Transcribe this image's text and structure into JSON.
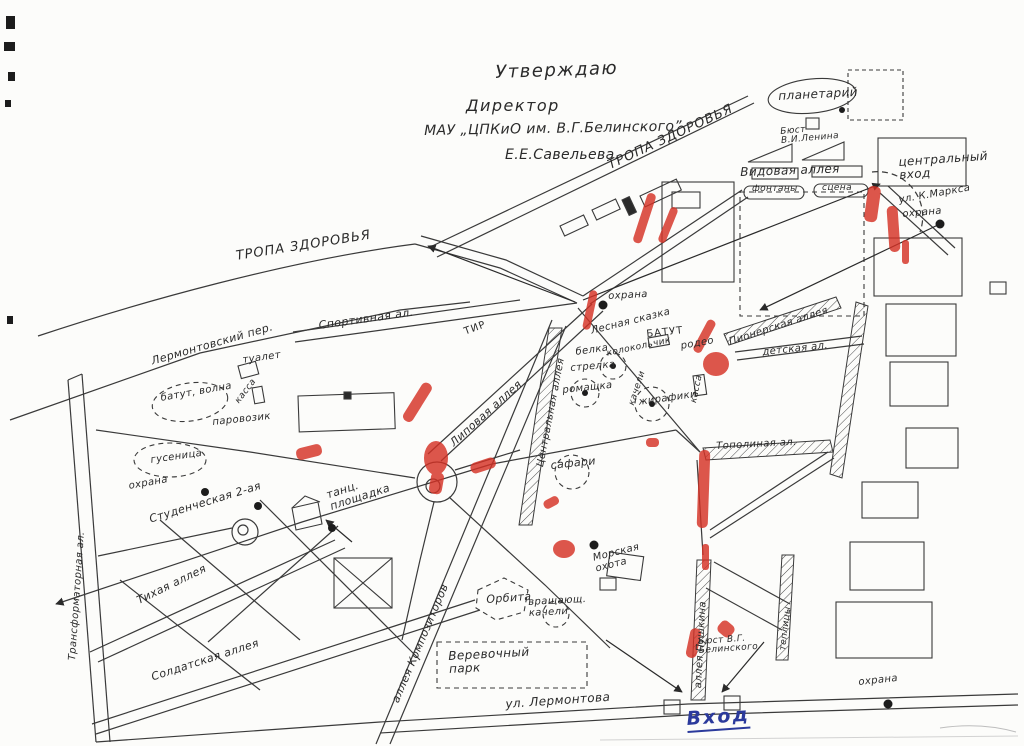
{
  "document": {
    "approval": {
      "line1": "Утверждаю",
      "line2": "Директор",
      "line3": "МАУ „ЦПКиО им. В.Г.Белинского”",
      "line4": "Е.Е.Савельева."
    }
  },
  "common": {
    "ohrana": "охрана",
    "kassa": "касса"
  },
  "streets": {
    "tropa_zdorovya": "ТРОПА ЗДОРОВЬЯ",
    "lermontovsky_per": "Лермонтовский пер.",
    "sportivnaya": "Спортивная ал.",
    "studencheskaya": "Студенческая 2-ая",
    "tihaya": "Тихая аллея",
    "transformatornaya": "Трансформаторная ал.",
    "soldatskaya": "Солдатская аллея",
    "kompozitorov": "аллея Композиторов",
    "tsentralnaya": "Центральная аллея",
    "lipovaya": "Липовая аллея",
    "topolinaya": "Тополиная ал.",
    "pionerskaya": "Пионерская аллея",
    "detskaya": "детская ал.",
    "pushkina": "аллея Пушкина",
    "ul_k_marksa": "ул. К.Маркса",
    "ul_lermontova": "ул. Лермонтова",
    "vidovaya": "Видовая аллея"
  },
  "places": {
    "planetariy": "планетарий",
    "byust_lenina": "Бюст В.И.Ленина",
    "fontany": "фонтаны",
    "scena": "сцена",
    "tsentralny_vhod": "центральный вход",
    "tir": "ТИР",
    "tualet": "туалет",
    "tants_ploshchadka": "танц. площадка",
    "verevochny_park": "Веревочный парк",
    "orbita": "Орбита",
    "teplitsy": "теплицы",
    "byust_belinskogo": "Бюст В.Г. Белинского",
    "vhod": "Вход"
  },
  "attractions": {
    "lesnaya_skazka": "Лесная сказка",
    "belka": "белка",
    "strelka": "стрелка",
    "batut": "БАТУТ",
    "rodeo": "родео",
    "kolokolchik": "колокольчик",
    "romashka": "ромашка",
    "kacheli": "качели",
    "zhirafiki": "жирафики",
    "batut_volna": "батут, волна",
    "parovozik": "паровозик",
    "gusenitsa": "гусеница",
    "safari": "сафари",
    "morskaya_ohota": "Морская охота",
    "vrashch_kacheli": "вращающ. качели"
  },
  "colors": {
    "ink": "#2f2f2f",
    "marker_red": "#d53125",
    "pen_blue": "#2b3a9c",
    "paper": "#fcfcfa"
  }
}
